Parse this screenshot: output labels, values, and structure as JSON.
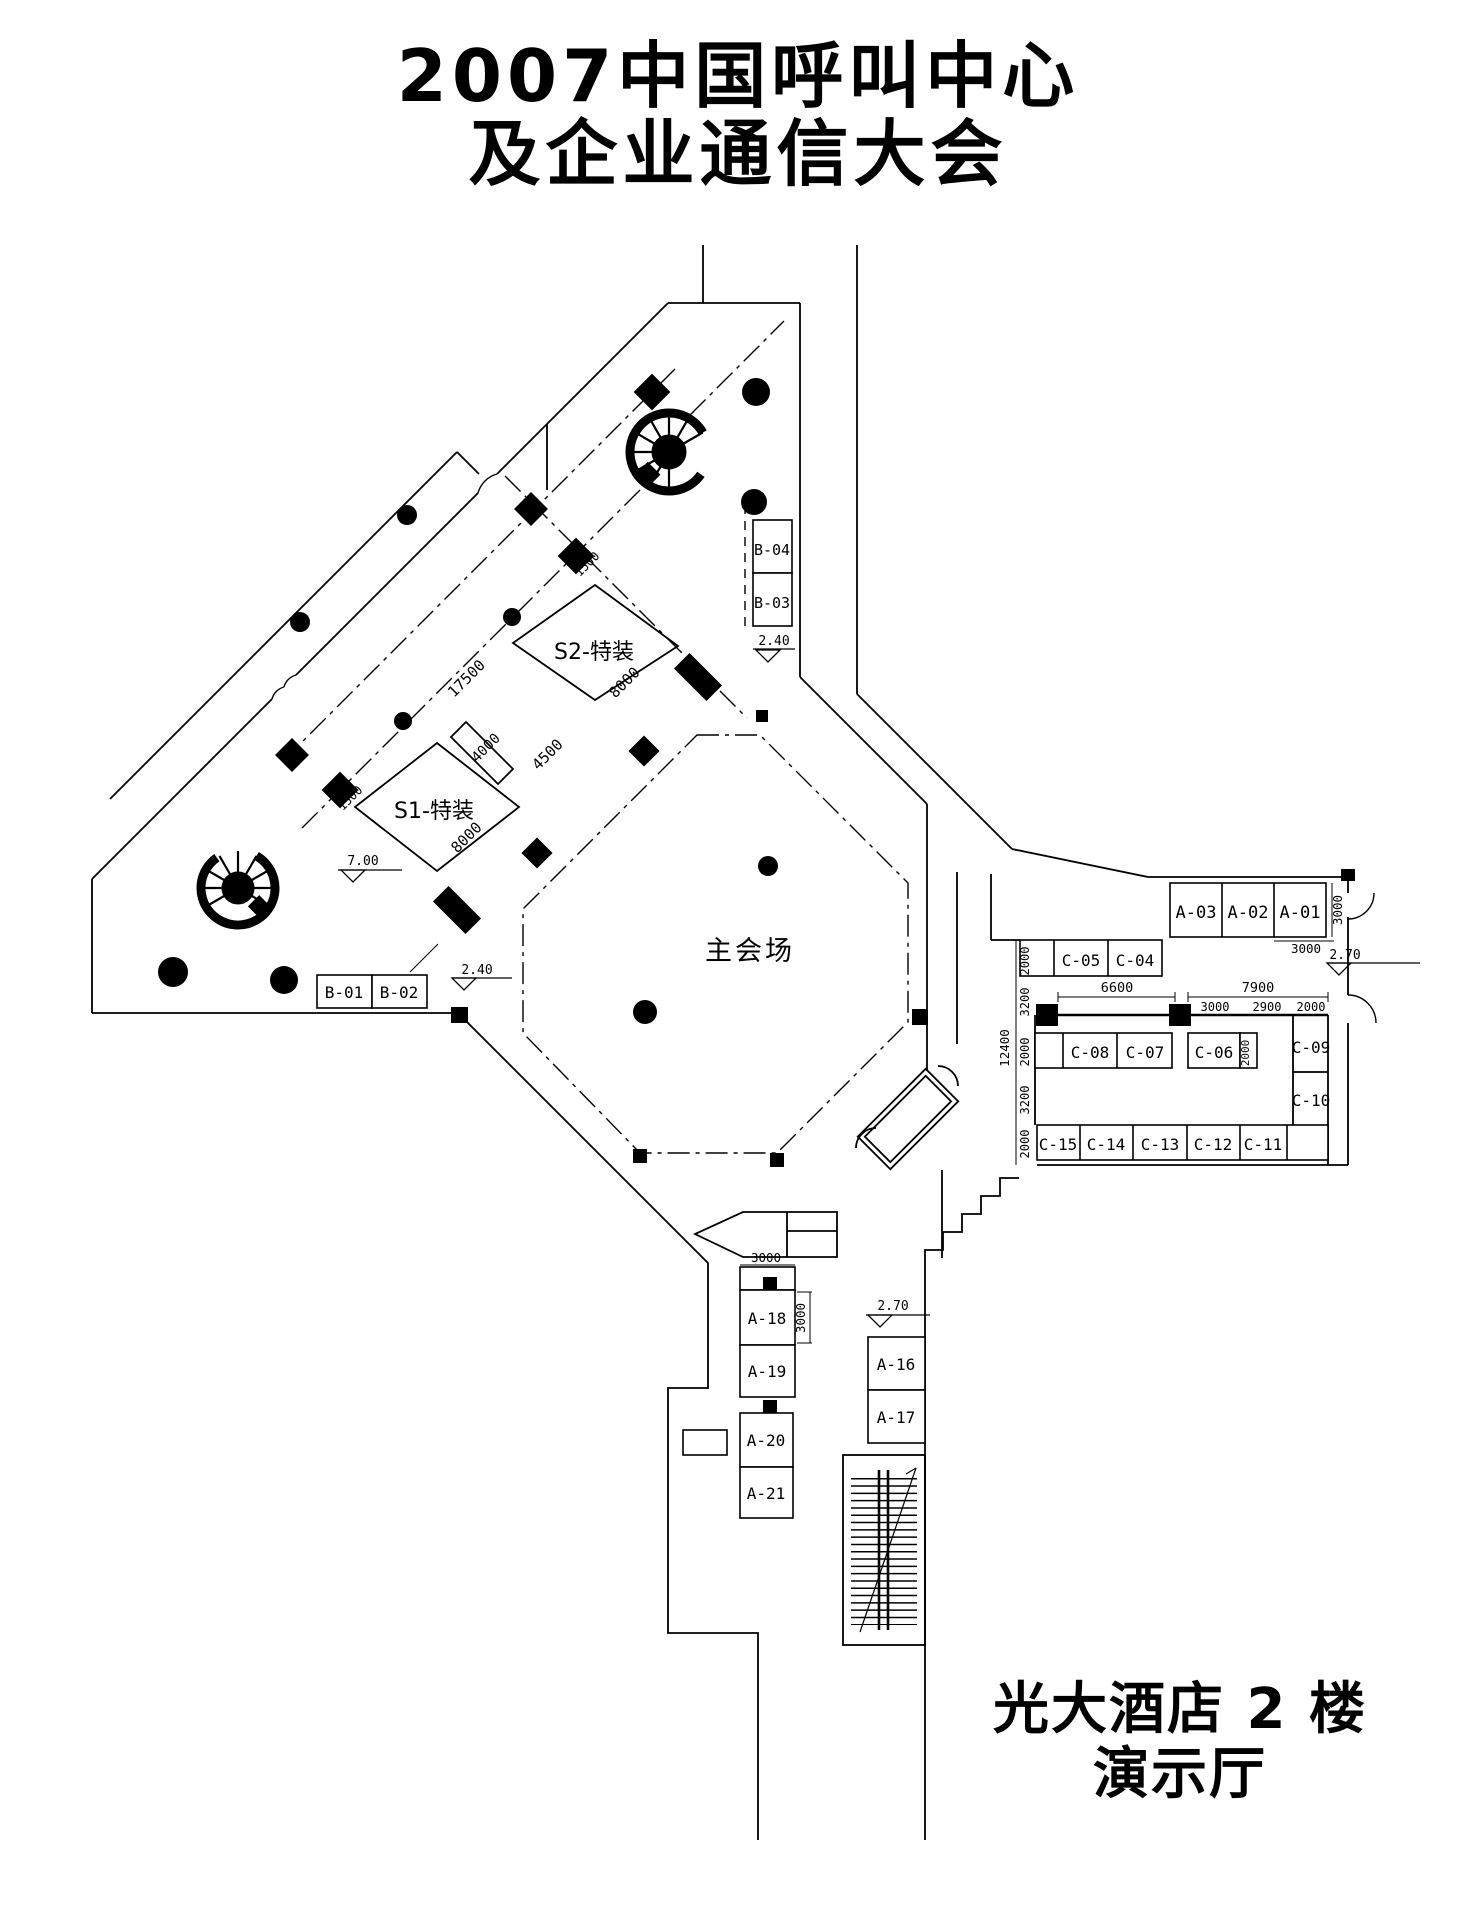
{
  "title": {
    "line1": "2007中国呼叫中心",
    "line2": "及企业通信大会"
  },
  "footer": {
    "line1": "光大酒店 2 楼",
    "line2": "演示厅"
  },
  "areas": {
    "main_hall": "主会场",
    "s2": "S2-特装",
    "s1": "S1-特装"
  },
  "booths": {
    "B04": "B-04",
    "B03": "B-03",
    "B01": "B-01",
    "B02": "B-02",
    "A03": "A-03",
    "A02": "A-02",
    "A01": "A-01",
    "C05": "C-05",
    "C04": "C-04",
    "C08": "C-08",
    "C07": "C-07",
    "C06": "C-06",
    "C09": "C-09",
    "C10": "C-10",
    "C15": "C-15",
    "C14": "C-14",
    "C13": "C-13",
    "C12": "C-12",
    "C11": "C-11",
    "A18": "A-18",
    "A19": "A-19",
    "A20": "A-20",
    "A21": "A-21",
    "A16": "A-16",
    "A17": "A-17"
  },
  "dims": {
    "upper_axis": "17500",
    "s2_edge": "8000",
    "s2_side": "4500",
    "s1_top": "4000",
    "s1_edge": "8000",
    "diamond_upper": "1500",
    "diamond_lower": "1500",
    "a01_w": "3000",
    "a01_h": "3000",
    "c_span_left": "6600",
    "c_span_right": "7900",
    "c_sub_1": "3000",
    "c_sub_2": "2900",
    "c_sub_3": "2000",
    "c_left_1": "2000",
    "c_left_2": "3200",
    "c_left_3": "2000",
    "c_left_4": "3200",
    "c_left_5": "2000",
    "c_left_total": "12400",
    "c06_side": "2000",
    "a18_w": "3000",
    "a18_h": "3000"
  },
  "elevations": {
    "b03": "2.40",
    "b02": "2.40",
    "s1": "7.00",
    "right": "2.70",
    "a16": "2.70"
  }
}
